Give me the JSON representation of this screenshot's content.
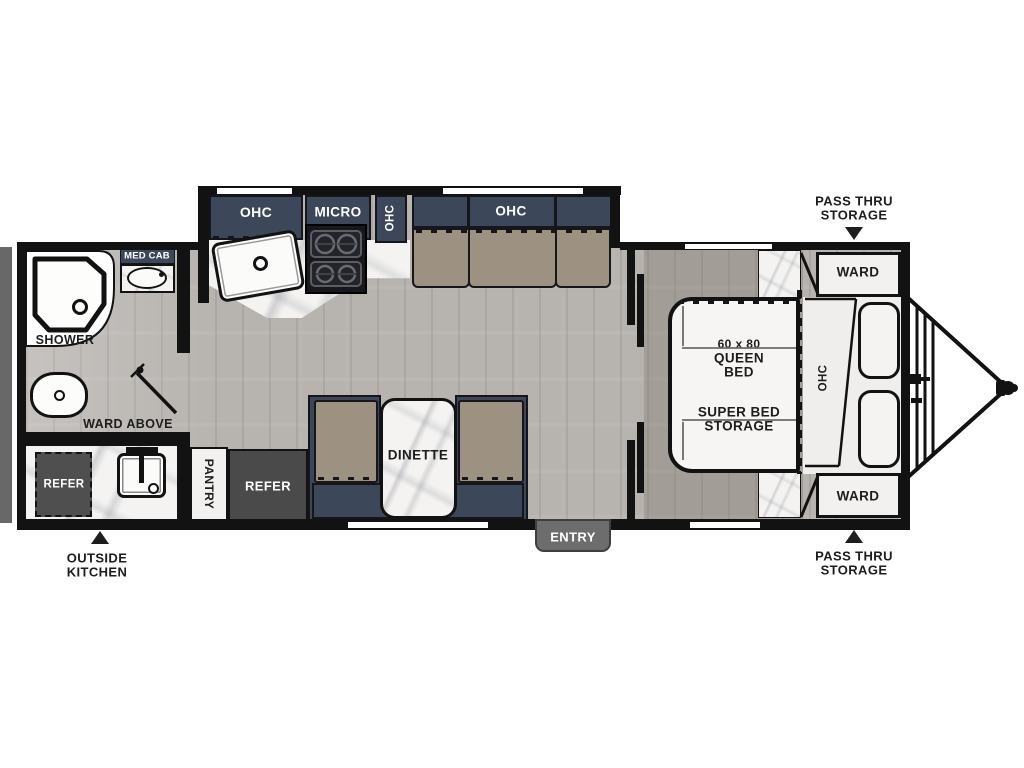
{
  "callouts": {
    "pass_thru_top": {
      "line1": "PASS THRU",
      "line2": "STORAGE"
    },
    "pass_thru_bottom": {
      "line1": "PASS THRU",
      "line2": "STORAGE"
    },
    "outside_kitchen": {
      "line1": "OUTSIDE",
      "line2": "KITCHEN"
    },
    "entry": "ENTRY"
  },
  "bathroom": {
    "shower": "SHOWER",
    "med_cab": "MED CAB",
    "ward_above": "WARD ABOVE"
  },
  "outside_kitchen_bay": {
    "refer": "REFER"
  },
  "kitchen": {
    "ohc": "OHC",
    "micro": "MICRO",
    "ohc_side": "OHC",
    "pantry": "PANTRY",
    "refer": "REFER"
  },
  "living": {
    "sofa_ohc": "OHC",
    "dinette": "DINETTE",
    "dinette_ohc": "OHC"
  },
  "bedroom": {
    "ward_top": "WARD",
    "ward_bottom": "WARD",
    "ohc": "OHC",
    "bed_size": "60 x 80",
    "bed_type": "QUEEN",
    "bed_word": "BED",
    "storage_line1": "SUPER BED",
    "storage_line2": "STORAGE"
  },
  "colors": {
    "cabinet_navy": "#3c4759",
    "cushion_tan": "#9d9182",
    "wall_black": "#121212",
    "floor_wood": "#b7b3af",
    "bedroom_floor_tint": "#a49d97",
    "marble": "#f4f3f1",
    "appliance_gray": "#4a4a4a",
    "entry_gray": "#6d6d6d",
    "bumper_gray": "#686868"
  }
}
